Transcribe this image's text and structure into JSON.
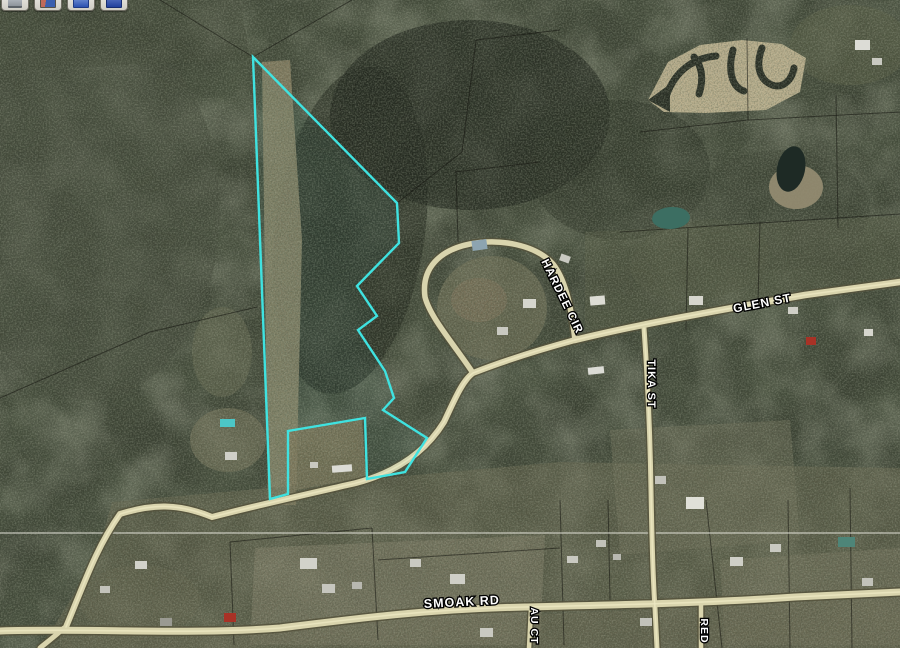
{
  "app": {
    "title": "Aerial parcel map viewer"
  },
  "toolbar": {
    "buttons": [
      {
        "icon": "printer-icon"
      },
      {
        "icon": "image-icon"
      },
      {
        "icon": "email-icon"
      },
      {
        "icon": "save-icon"
      }
    ]
  },
  "map": {
    "size": {
      "w": 900,
      "h": 648
    },
    "palette": {
      "base": "#3a4032",
      "accent_parcel": "#3fe2e0",
      "road_fill": "#d9d4ad"
    },
    "patches": [
      {
        "e": [
          90,
          210,
          130,
          190
        ],
        "fill": "#454b3d",
        "op": 0.55,
        "rot": 0
      },
      {
        "e": [
          350,
          230,
          75,
          165
        ],
        "fill": "#23281e",
        "op": 0.6,
        "rot": 8
      },
      {
        "e": [
          470,
          115,
          140,
          95
        ],
        "fill": "#1f241b",
        "op": 0.65,
        "rot": 0
      },
      {
        "e": [
          620,
          170,
          90,
          70
        ],
        "fill": "#2a3024",
        "op": 0.5,
        "rot": 0
      },
      {
        "e": [
          780,
          210,
          90,
          60
        ],
        "fill": "#3c4233",
        "op": 0.5,
        "rot": 0
      },
      {
        "e": [
          700,
          260,
          70,
          40
        ],
        "fill": "#4e5340",
        "op": 0.5,
        "rot": -8
      },
      {
        "e": [
          222,
          352,
          30,
          45
        ],
        "fill": "#666951",
        "op": 0.6,
        "rot": 0
      },
      {
        "e": [
          228,
          440,
          38,
          32
        ],
        "fill": "#75735a",
        "op": 0.65,
        "rot": 0
      },
      {
        "e": [
          492,
          308,
          55,
          52
        ],
        "fill": "#6e6e56",
        "op": 0.75,
        "rot": 0
      },
      {
        "e": [
          479,
          300,
          28,
          22
        ],
        "fill": "#7b7158",
        "op": 0.7,
        "rot": 0
      },
      {
        "e": [
          850,
          45,
          60,
          40
        ],
        "fill": "#565b45",
        "op": 0.6,
        "rot": 0
      },
      {
        "e": [
          140,
          600,
          60,
          35
        ],
        "fill": "#5a5c47",
        "op": 0.5,
        "rot": 0
      },
      {
        "pts": "0,0 240,0 250,60 0,70",
        "fill": "#3f4536",
        "op": 0.5
      },
      {
        "pts": "262,62 290,60 302,240 296,505 268,505",
        "fill": "#8d8466",
        "op": 0.85
      },
      {
        "pts": "272,432 362,419 366,477 292,491",
        "fill": "#7e795d",
        "op": 0.8
      },
      {
        "pts": "585,232 900,216 900,278 585,332",
        "fill": "#575a44",
        "op": 0.45
      },
      {
        "pts": "112,502 360,480 560,462 900,468 900,648 40,648 96,560",
        "fill": "#6e6c54",
        "op": 0.5
      },
      {
        "pts": "255,548 545,535 540,645 250,645",
        "fill": "#83806a",
        "op": 0.55
      },
      {
        "pts": "610,430 790,420 800,540 620,555",
        "fill": "#6f705a",
        "op": 0.5
      },
      {
        "pts": "720,560 900,548 900,645 725,645",
        "fill": "#77755f",
        "op": 0.5
      },
      {
        "pts": "60,632 530,615 900,598 900,648 60,648",
        "fill": "#6a6852",
        "op": 0.45
      }
    ],
    "excavation": {
      "blob": "648,100 668,62 700,45 742,40 782,44 806,58 800,92 766,110 706,113 664,112",
      "arrow": "648,100 670,84 670,112",
      "fill": "#c3b694",
      "mark_color": "#262b22",
      "marks": [
        "M667,94 C676,70 694,58 716,56",
        "M699,94 C704,79 702,66 694,57",
        "M733,50 C728,69 731,87 744,91",
        "M762,48 C756,64 758,79 772,85 C783,89 792,80 794,68"
      ]
    },
    "ponds": [
      {
        "name": "pond-shore",
        "e": [
          796,
          187,
          27,
          22
        ],
        "fill": "#968d72",
        "op": 0.9,
        "rot": 0
      },
      {
        "name": "dark-pond",
        "e": [
          791,
          169,
          14,
          23
        ],
        "fill": "#1e2a25",
        "op": 1,
        "rot": 12
      },
      {
        "name": "teal-pond",
        "e": [
          671,
          218,
          19,
          11
        ],
        "fill": "#3c6e62",
        "op": 1,
        "rot": -4
      }
    ],
    "section_line": {
      "y": 533,
      "color": "#e2e2d8",
      "opacity": 0.5
    },
    "parcel_lines": {
      "color": "#14140f",
      "opacity": 0.55,
      "segments": [
        [
          160,
          0,
          253,
          57
        ],
        [
          253,
          57,
          352,
          0
        ],
        [
          397,
          203,
          462,
          152
        ],
        [
          462,
          152,
          476,
          40
        ],
        [
          476,
          40,
          560,
          30
        ],
        [
          0,
          398,
          150,
          332
        ],
        [
          150,
          332,
          257,
          307
        ],
        [
          747,
          38,
          748,
          120
        ],
        [
          748,
          120,
          900,
          112
        ],
        [
          640,
          132,
          748,
          120
        ],
        [
          836,
          95,
          838,
          228
        ],
        [
          620,
          232,
          900,
          214
        ],
        [
          688,
          228,
          686,
          330
        ],
        [
          760,
          222,
          758,
          302
        ],
        [
          455,
          172,
          540,
          162
        ],
        [
          456,
          172,
          458,
          242
        ],
        [
          230,
          542,
          234,
          645
        ],
        [
          230,
          542,
          372,
          528
        ],
        [
          372,
          528,
          378,
          640
        ],
        [
          378,
          560,
          560,
          548
        ],
        [
          560,
          500,
          564,
          645
        ],
        [
          608,
          500,
          610,
          600
        ],
        [
          706,
          500,
          722,
          648
        ],
        [
          788,
          500,
          790,
          648
        ],
        [
          850,
          488,
          852,
          648
        ]
      ]
    },
    "road_colors": {
      "casing": "#55523c",
      "fill": "#d9d4ad",
      "highlight": "#ece7c2"
    },
    "roads": [
      {
        "name": "connector-road",
        "d": "M66,627 C84,584 96,548 120,514 C152,504 178,503 212,517 C250,507 308,494 356,483 C398,472 426,451 444,422 C454,401 462,381 473,373 C506,360 542,349 575,340",
        "w": 6,
        "hi": true
      },
      {
        "name": "glen-st",
        "d": "M575,340 C640,324 725,309 805,295 L900,282",
        "w": 6.5,
        "hi": true
      },
      {
        "name": "hardee-cir",
        "d": "M473,373 C453,343 430,317 425,297 C421,268 440,250 470,244 C500,238 536,245 553,264 C568,283 572,316 575,340",
        "w": 5.5,
        "hi": false
      },
      {
        "name": "tika-st",
        "d": "M644,328 C647,370 650,430 651,490 C652,545 653,580 655,608 L657,648",
        "w": 5,
        "hi": true
      },
      {
        "name": "smoak-rd",
        "d": "M0,631 C90,628 190,635 280,628 C360,618 430,609 525,607 C615,605 710,603 795,597 L900,592",
        "w": 7,
        "hi": true
      },
      {
        "name": "smoak-sw-stub",
        "d": "M64,628 C54,637 46,643 40,648",
        "w": 5,
        "hi": false
      },
      {
        "name": "au-ct",
        "d": "M531,609 L529,648",
        "w": 4.5,
        "hi": false
      },
      {
        "name": "red-st",
        "d": "M701,605 L701,648",
        "w": 4.5,
        "hi": false
      }
    ],
    "buildings": [
      [
        472,
        240,
        15,
        10,
        "#8da4b0",
        -8
      ],
      [
        523,
        299,
        13,
        9,
        "#d6d6ce",
        0
      ],
      [
        497,
        327,
        11,
        8,
        "#c9c9c1",
        0
      ],
      [
        560,
        255,
        10,
        7,
        "#c9c9c1",
        20
      ],
      [
        590,
        296,
        15,
        9,
        "#dcdcd4",
        -5
      ],
      [
        689,
        296,
        14,
        9,
        "#d6d6ce",
        0
      ],
      [
        806,
        337,
        10,
        8,
        "#a83226",
        0
      ],
      [
        788,
        307,
        10,
        7,
        "#cfcfc7",
        0
      ],
      [
        864,
        329,
        9,
        7,
        "#d6d6ce",
        0
      ],
      [
        588,
        367,
        16,
        7,
        "#dcdcd6",
        -6
      ],
      [
        686,
        497,
        18,
        12,
        "#e0e0d8",
        0
      ],
      [
        655,
        476,
        11,
        8,
        "#c2c2ba",
        0
      ],
      [
        730,
        557,
        13,
        9,
        "#cfcfc7",
        0
      ],
      [
        770,
        544,
        11,
        8,
        "#c9c9c1",
        0
      ],
      [
        838,
        537,
        17,
        10,
        "#4e8578",
        0
      ],
      [
        862,
        578,
        11,
        8,
        "#c2c2ba",
        0
      ],
      [
        300,
        558,
        17,
        11,
        "#d2d2ca",
        0
      ],
      [
        322,
        584,
        13,
        9,
        "#c6c6be",
        0
      ],
      [
        410,
        559,
        11,
        8,
        "#c9c9c1",
        0
      ],
      [
        450,
        574,
        15,
        10,
        "#cfcfc7",
        0
      ],
      [
        352,
        582,
        10,
        7,
        "#b8b8b0",
        0
      ],
      [
        480,
        628,
        13,
        9,
        "#c9c9c1",
        0
      ],
      [
        640,
        618,
        12,
        8,
        "#c2c2ba",
        0
      ],
      [
        224,
        613,
        12,
        9,
        "#a83226",
        0
      ],
      [
        160,
        618,
        12,
        8,
        "#9a9a92",
        0
      ],
      [
        135,
        561,
        12,
        8,
        "#d2d2ca",
        0
      ],
      [
        100,
        586,
        10,
        7,
        "#c2c2ba",
        0
      ],
      [
        332,
        465,
        20,
        7,
        "#dcdcd6",
        -4
      ],
      [
        310,
        462,
        8,
        6,
        "#c9c9c1",
        0
      ],
      [
        225,
        452,
        12,
        8,
        "#cfcfc7",
        0
      ],
      [
        855,
        40,
        15,
        10,
        "#dcdcd6",
        0
      ],
      [
        872,
        58,
        10,
        7,
        "#c9c9c1",
        0
      ],
      [
        596,
        540,
        10,
        7,
        "#c2c2ba",
        0
      ],
      [
        613,
        554,
        8,
        6,
        "#b8b8b0",
        0
      ],
      [
        567,
        556,
        11,
        7,
        "#c9c9c1",
        0
      ],
      [
        220,
        419,
        15,
        8,
        "#4cc6c6",
        0
      ]
    ],
    "parcel": {
      "color": "#3fe2e0",
      "width": 2.4,
      "points": "253,57 397,203 399,243 357,286 377,316 358,330 385,371 394,398 383,410 427,438 405,472 367,479 365,418 288,431 288,494 270,499"
    },
    "labels": [
      {
        "id": "smoak-rd",
        "text": "SMOAK RD",
        "x": 462,
        "y": 606,
        "rot": -3,
        "size": 12.5
      },
      {
        "id": "glen-st",
        "text": "GLEN ST",
        "x": 763,
        "y": 307,
        "rot": -11,
        "size": 12
      },
      {
        "id": "hardee-cir",
        "text": "HARDEE CIR",
        "x": 559,
        "y": 298,
        "rot": 64,
        "size": 11.5
      },
      {
        "id": "tika-st",
        "text": "TIKA ST",
        "x": 648,
        "y": 384,
        "rot": 90,
        "size": 11
      },
      {
        "id": "au-ct",
        "text": "AU CT",
        "x": 531,
        "y": 626,
        "rot": 90,
        "size": 10.5
      },
      {
        "id": "red",
        "text": "RED",
        "x": 701,
        "y": 631,
        "rot": 90,
        "size": 10.5
      }
    ]
  }
}
